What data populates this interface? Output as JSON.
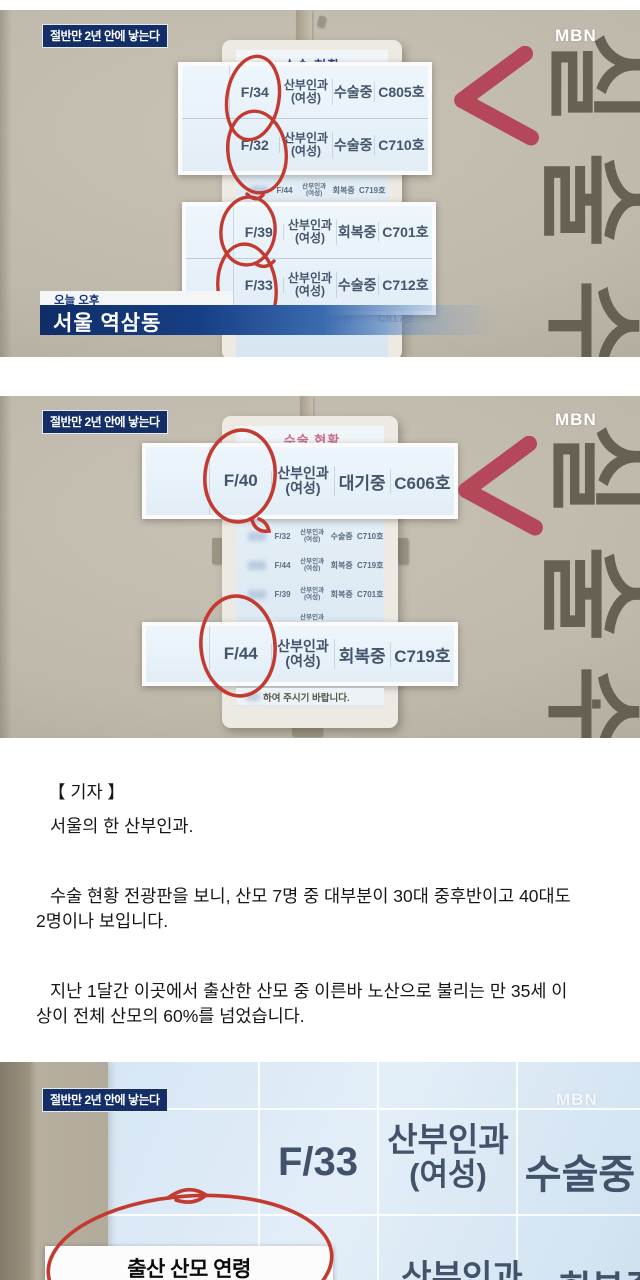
{
  "badge": "절반만 2년 안에 낳는다",
  "brand": "MBN",
  "s1": {
    "board_title": "수술 현황",
    "signage": "수술실",
    "signage_dot": "·",
    "rows_top": [
      {
        "age": "F/34",
        "dept": "산부인과",
        "dept2": "(여성)",
        "status": "수술중",
        "room": "C805호"
      },
      {
        "age": "F/32",
        "dept": "산부인과",
        "dept2": "(여성)",
        "status": "수술중",
        "room": "C710호"
      }
    ],
    "row_small": {
      "age": "F/44",
      "dept": "산부인과",
      "dept2": "(여성)",
      "status": "회복중",
      "room": "C719호"
    },
    "rows_bottom": [
      {
        "age": "F/39",
        "dept": "산부인과",
        "dept2": "(여성)",
        "status": "회복중",
        "room": "C701호"
      },
      {
        "age": "F/33",
        "dept": "산부인과",
        "dept2": "(여성)",
        "status": "수술중",
        "room": "C712호"
      }
    ],
    "faint_status": "수술중",
    "faint_room": "C817호",
    "caption_small": "오늘 오후",
    "caption_main": "서울 역삼동"
  },
  "s2": {
    "board_title": "수술 현황",
    "signage": "수술실",
    "signage_dot": "·",
    "row_top": {
      "age": "F/40",
      "dept": "산부인과",
      "dept2": "(여성)",
      "status": "대기중",
      "room": "C606호"
    },
    "rows_small": [
      {
        "age": "F/32",
        "dept": "산부인과",
        "dept2": "(여성)",
        "status": "수술중",
        "room": "C710호"
      },
      {
        "age": "F/44",
        "dept": "산부인과",
        "dept2": "(여성)",
        "status": "회복중",
        "room": "C719호"
      },
      {
        "age": "F/39",
        "dept": "산부인과",
        "dept2": "(여성)",
        "status": "회복중",
        "room": "C701호"
      }
    ],
    "partial_dept": "산부인과",
    "row_bottom": {
      "age": "F/44",
      "dept": "산부인과",
      "dept2": "(여성)",
      "status": "회복중",
      "room": "C719호"
    },
    "footer_note": "하여 주시기 바랍니다."
  },
  "article": {
    "reporter_label": "【 기자 】",
    "p1": "서울의 한 산부인과.",
    "p2": "수술 현황 전광판을 보니, 산모 7명 중 대부분이 30대 중후반이고 40대도 2명이나 보입니다.",
    "p3": "지난 1달간 이곳에서 출산한 산모 중 이른바 노산으로 불리는 만 35세 이상이 전체 산모의 60%를 넘었습니다."
  },
  "s3": {
    "row": {
      "age": "F/33",
      "dept": "산부인과",
      "dept2": "(여성)",
      "status": "수술중"
    },
    "row_partial": {
      "dept": "산부인과",
      "status": "회복중"
    },
    "infobox_title": "출산 산모 연령",
    "infobox_source": "(자료 : 강남차병원 산부인과  기간 : 7월 22일~8월 23일)"
  },
  "colors": {
    "annotation_red": "#c33a31",
    "chevron_red": "#b4485a",
    "badge_navy": "#142e68",
    "caption_navy": "#0f2d67",
    "board_title_navy": "#3c4a8a",
    "board_title_pink": "#c96d88",
    "wall_beige": "#bfb9ab",
    "screen_blue": "#d8e6f1"
  }
}
